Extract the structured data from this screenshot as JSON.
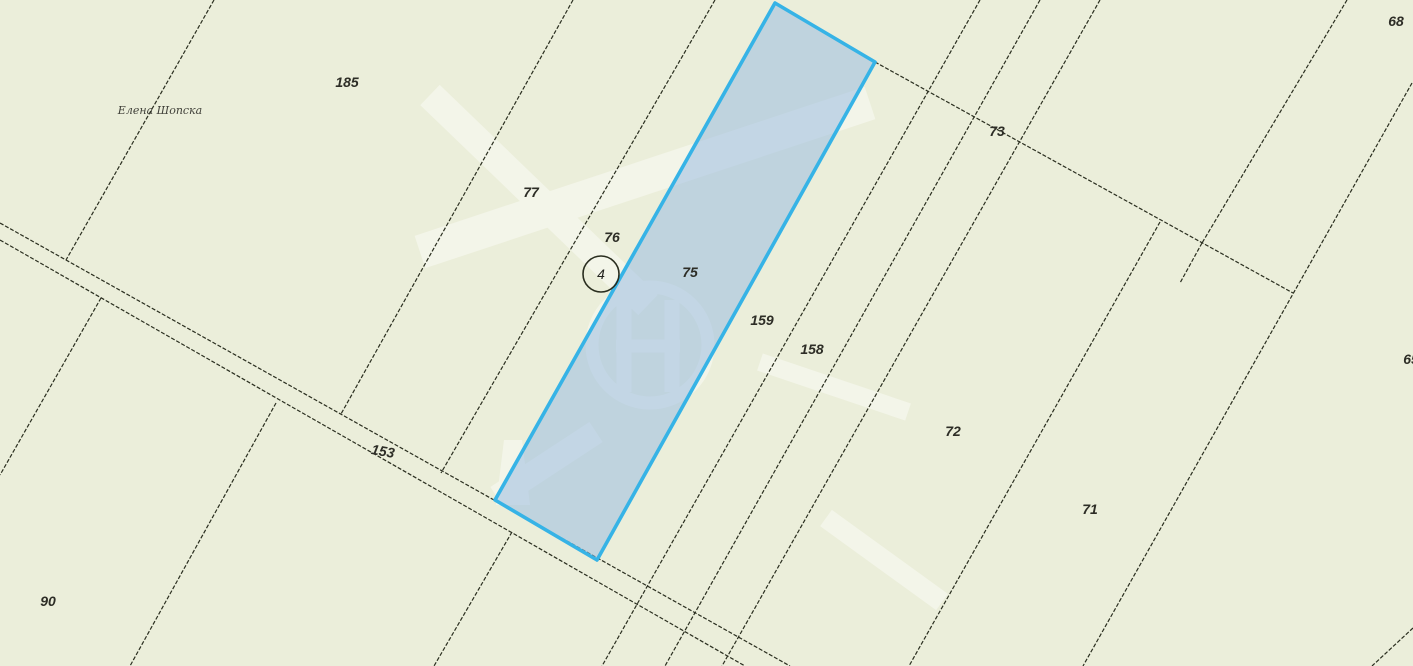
{
  "map": {
    "width": 1413,
    "height": 666,
    "colors": {
      "background": "#ebeeda",
      "boundary_line": "#2a2e1f",
      "selected_border": "#36b3e6",
      "selected_fill": "rgba(148,184,226,0.5)",
      "label_text": "#2d2d26",
      "watermark": "#ffffff"
    },
    "road": {
      "name": "road-parcel-153",
      "upper": [
        [
          0,
          223
        ],
        [
          790,
          666
        ]
      ],
      "lower": [
        [
          0,
          240
        ],
        [
          745,
          666
        ]
      ]
    },
    "boundaries": [
      {
        "name": "boundary-185-west",
        "points": [
          [
            214,
            0
          ],
          [
            66,
            260
          ]
        ]
      },
      {
        "name": "boundary-left-below-road",
        "points": [
          [
            101,
            298
          ],
          [
            0,
            475
          ]
        ]
      },
      {
        "name": "boundary-90-east",
        "points": [
          [
            276,
            403
          ],
          [
            130,
            666
          ]
        ]
      },
      {
        "name": "boundary-185-77",
        "points": [
          [
            573,
            0
          ],
          [
            341,
            414
          ]
        ]
      },
      {
        "name": "boundary-below-road-mid",
        "points": [
          [
            512,
            532
          ],
          [
            434,
            666
          ]
        ]
      },
      {
        "name": "boundary-77-76",
        "points": [
          [
            715,
            0
          ],
          [
            441,
            473
          ]
        ]
      },
      {
        "name": "boundary-159-158",
        "points": [
          [
            980,
            0
          ],
          [
            602,
            666
          ]
        ]
      },
      {
        "name": "boundary-158-73",
        "points": [
          [
            1040,
            0
          ],
          [
            665,
            666
          ]
        ]
      },
      {
        "name": "boundary-73-72",
        "points": [
          [
            1100,
            0
          ],
          [
            722,
            666
          ]
        ]
      },
      {
        "name": "boundary-72-71",
        "points": [
          [
            1160,
            222
          ],
          [
            909,
            666
          ]
        ]
      },
      {
        "name": "boundary-73-68",
        "points": [
          [
            1347,
            0
          ],
          [
            1202,
            243
          ]
        ]
      },
      {
        "name": "boundary-68-stub",
        "points": [
          [
            1202,
            243
          ],
          [
            1180,
            283
          ]
        ]
      },
      {
        "name": "boundary-68-65",
        "points": [
          [
            1412,
            83
          ],
          [
            1083,
            666
          ]
        ]
      },
      {
        "name": "boundary-corner-se",
        "points": [
          [
            1413,
            628
          ],
          [
            1372,
            666
          ]
        ]
      },
      {
        "name": "boundary-north-75-link",
        "points": [
          [
            875,
            62
          ],
          [
            1293,
            293
          ]
        ]
      }
    ],
    "selected_parcel": {
      "number": "75",
      "outline": [
        [
          775,
          3
        ],
        [
          875,
          62
        ],
        [
          597,
          560
        ],
        [
          495,
          500
        ]
      ]
    },
    "marker": {
      "label": "4",
      "cx": 601,
      "cy": 274,
      "r": 18
    },
    "owner_label": {
      "text": "Елена Шопска",
      "x": 160,
      "y": 110
    },
    "parcel_labels": [
      {
        "text": "185",
        "x": 347,
        "y": 82
      },
      {
        "text": "77",
        "x": 531,
        "y": 192
      },
      {
        "text": "76",
        "x": 612,
        "y": 237
      },
      {
        "text": "75",
        "x": 690,
        "y": 272
      },
      {
        "text": "159",
        "x": 762,
        "y": 320
      },
      {
        "text": "158",
        "x": 812,
        "y": 349
      },
      {
        "text": "73",
        "x": 997,
        "y": 131
      },
      {
        "text": "68",
        "x": 1396,
        "y": 21
      },
      {
        "text": "65",
        "x": 1411,
        "y": 359
      },
      {
        "text": "72",
        "x": 953,
        "y": 431
      },
      {
        "text": "71",
        "x": 1090,
        "y": 509
      },
      {
        "text": "153",
        "x": 383,
        "y": 451,
        "rotate": 10
      },
      {
        "text": "90",
        "x": 48,
        "y": 601
      }
    ],
    "watermark": {
      "opacity": 0.42,
      "bands": [
        {
          "x1": 870,
          "y1": 103,
          "x2": 420,
          "y2": 252,
          "w": 34
        },
        {
          "x1": 430,
          "y1": 95,
          "x2": 648,
          "y2": 305,
          "w": 28
        },
        {
          "x1": 760,
          "y1": 362,
          "x2": 908,
          "y2": 412,
          "w": 18
        },
        {
          "x1": 826,
          "y1": 518,
          "x2": 942,
          "y2": 602,
          "w": 20
        },
        {
          "x1": 596,
          "y1": 432,
          "x2": 497,
          "y2": 497,
          "w": 24
        }
      ],
      "circle": {
        "cx": 650,
        "cy": 345,
        "r": 58,
        "stroke_w": 13
      },
      "glyph_bars": [
        {
          "x1": 624,
          "y1": 300,
          "x2": 624,
          "y2": 392,
          "w": 15
        },
        {
          "x1": 672,
          "y1": 300,
          "x2": 672,
          "y2": 392,
          "w": 15
        },
        {
          "x1": 616,
          "y1": 346,
          "x2": 680,
          "y2": 346,
          "w": 13
        }
      ],
      "tower": [
        [
          504,
          440
        ],
        [
          522,
          440
        ],
        [
          530,
          505
        ],
        [
          496,
          505
        ]
      ]
    }
  }
}
